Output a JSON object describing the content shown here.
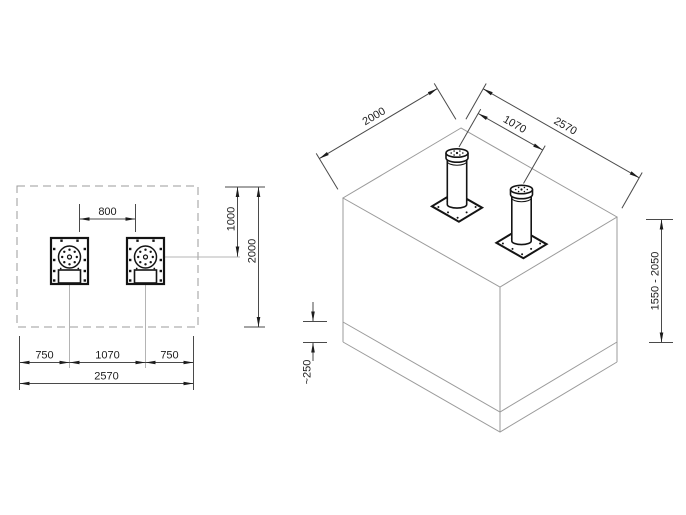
{
  "drawing_type": "bollard foundation installation drawing",
  "colors": {
    "background": "#ffffff",
    "construction_lines": "#9b9b9b",
    "dimension_lines": "#4a4a4a",
    "part_lines": "#141414",
    "text": "#1c1c1c"
  },
  "plan_view": {
    "dims": {
      "clear_spacing": "800",
      "center_from_top": "1000",
      "overall_depth": "2000",
      "edge_left": "750",
      "center_spacing": "1070",
      "edge_right": "750",
      "overall_width": "2570"
    }
  },
  "iso_view": {
    "dims": {
      "pit_width": "2000",
      "bollard_spacing": "1070",
      "pit_length": "2570",
      "depth_range": "1550 - 2050",
      "base_layer": "~250"
    }
  }
}
